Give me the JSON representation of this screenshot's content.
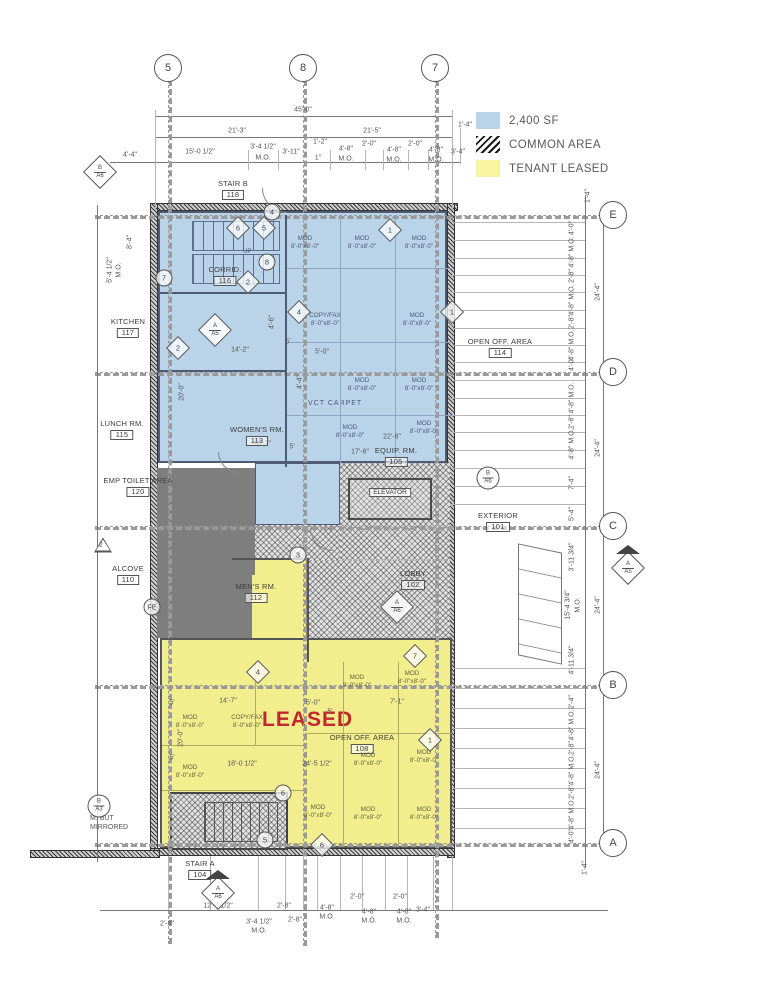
{
  "legend": {
    "items": [
      {
        "swatch": "sf",
        "label": "2,400 SF"
      },
      {
        "swatch": "common",
        "label": "COMMON AREA"
      },
      {
        "swatch": "leased",
        "label": "TENANT LEASED"
      }
    ]
  },
  "colors": {
    "tenant_blue": "#b9d3e8",
    "tenant_yellow": "#f3ee8d",
    "legend_yellow": "#f9f59f",
    "covered_gray": "#7e7e7e",
    "leased_red": "#c0282e",
    "line_gray": "#5a5a5a"
  },
  "grid": {
    "top": [
      {
        "label": "5",
        "x": 168
      },
      {
        "label": "8",
        "x": 303
      },
      {
        "label": "7",
        "x": 435
      }
    ],
    "right": [
      {
        "label": "E",
        "y": 215
      },
      {
        "label": "D",
        "y": 372
      },
      {
        "label": "C",
        "y": 526
      },
      {
        "label": "B",
        "y": 685
      },
      {
        "label": "A",
        "y": 843
      }
    ]
  },
  "rooms": [
    {
      "name": "STAIR B",
      "num": "118",
      "x": 233,
      "y": 180
    },
    {
      "name": "CORRID.",
      "num": "116",
      "x": 225,
      "y": 266
    },
    {
      "name": "KITCHEN",
      "num": "117",
      "x": 128,
      "y": 318
    },
    {
      "name": "LUNCH RM.",
      "num": "115",
      "x": 122,
      "y": 420
    },
    {
      "name": "WOMEN'S RM.",
      "num": "113",
      "x": 257,
      "y": 426
    },
    {
      "name": "EMP TOILET AREA",
      "num": "120",
      "x": 138,
      "y": 477
    },
    {
      "name": "ALCOVE",
      "num": "110",
      "x": 128,
      "y": 565
    },
    {
      "name": "MEN'S RM.",
      "num": "112",
      "x": 256,
      "y": 583
    },
    {
      "name": "OPEN OFF. AREA",
      "num": "114",
      "x": 500,
      "y": 338
    },
    {
      "name": "EQUIP. RM.",
      "num": "105",
      "x": 396,
      "y": 447
    },
    {
      "name": "ELEVATOR",
      "num": "",
      "x": 390,
      "y": 497
    },
    {
      "name": "LOBBY",
      "num": "102",
      "x": 413,
      "y": 570
    },
    {
      "name": "EXTERIOR",
      "num": "101",
      "x": 498,
      "y": 512
    },
    {
      "name": "OPEN OFF. AREA",
      "num": "108",
      "x": 362,
      "y": 734
    },
    {
      "name": "STAIR A",
      "num": "104",
      "x": 200,
      "y": 860
    }
  ],
  "mods": [
    {
      "a": "MOD",
      "s": "8'-0\"x8'-0\"",
      "x": 305,
      "y": 243,
      "c": "b"
    },
    {
      "a": "MOD",
      "s": "8'-0\"x8'-0\"",
      "x": 362,
      "y": 243,
      "c": "b"
    },
    {
      "a": "MOD",
      "s": "8'-0\"x8'-0\"",
      "x": 419,
      "y": 243,
      "c": "b"
    },
    {
      "a": "COPY/FAX",
      "s": "8'-0\"x8'-0\"",
      "x": 325,
      "y": 320,
      "c": "b"
    },
    {
      "a": "MOD",
      "s": "8'-0\"x8'-0\"",
      "x": 417,
      "y": 320,
      "c": "b"
    },
    {
      "a": "MOD",
      "s": "8'-0\"x8'-0\"",
      "x": 362,
      "y": 385,
      "c": "b"
    },
    {
      "a": "MOD",
      "s": "8'-0\"x8'-0\"",
      "x": 419,
      "y": 385,
      "c": "b"
    },
    {
      "a": "MOD",
      "s": "8'-0\"x8'-0\"",
      "x": 350,
      "y": 432,
      "c": "b"
    },
    {
      "a": "MOD",
      "s": "8'-0\"x8'-0\"",
      "x": 424,
      "y": 428,
      "c": "b"
    },
    {
      "a": "MOD",
      "s": "8'-0\"x8'-0\"",
      "x": 190,
      "y": 722,
      "c": "y"
    },
    {
      "a": "COPY/FAX",
      "s": "8'-0\"x8'-0\"",
      "x": 247,
      "y": 722,
      "c": "y"
    },
    {
      "a": "MOD",
      "s": "8'-0\"x8'-0\"",
      "x": 357,
      "y": 682,
      "c": "y"
    },
    {
      "a": "MOD",
      "s": "8'-0\"x8'-0\"",
      "x": 412,
      "y": 678,
      "c": "y"
    },
    {
      "a": "MOD",
      "s": "8'-0\"x8'-0\"",
      "x": 190,
      "y": 772,
      "c": "y"
    },
    {
      "a": "MOD",
      "s": "8'-0\"x8'-0\"",
      "x": 368,
      "y": 760,
      "c": "y"
    },
    {
      "a": "MOD",
      "s": "8'-0\"x8'-0\"",
      "x": 424,
      "y": 757,
      "c": "y"
    },
    {
      "a": "MOD",
      "s": "8'-0\"x8'-0\"",
      "x": 318,
      "y": 812,
      "c": "y"
    },
    {
      "a": "MOD",
      "s": "8'-0\"x8'-0\"",
      "x": 368,
      "y": 814,
      "c": "y"
    },
    {
      "a": "MOD",
      "s": "8'-0\"x8'-0\"",
      "x": 424,
      "y": 814,
      "c": "y"
    }
  ],
  "dimensions": [
    {
      "t": "45'-0\"",
      "x": 303,
      "y": 110
    },
    {
      "t": "21'-3\"",
      "x": 237,
      "y": 131
    },
    {
      "t": "21'-5\"",
      "x": 372,
      "y": 131
    },
    {
      "t": "1'-4\"",
      "x": 465,
      "y": 125
    },
    {
      "t": "4'-4\"",
      "x": 130,
      "y": 155
    },
    {
      "t": "15'-0 1/2\"",
      "x": 200,
      "y": 152
    },
    {
      "t": "3'-4 1/2\"",
      "x": 263,
      "y": 147
    },
    {
      "t": "M.O.",
      "x": 263,
      "y": 158
    },
    {
      "t": "3'-11\"",
      "x": 291,
      "y": 152
    },
    {
      "t": "1'-2\"",
      "x": 320,
      "y": 142
    },
    {
      "t": "1\"",
      "x": 318,
      "y": 158
    },
    {
      "t": "4'-8\"",
      "x": 346,
      "y": 149
    },
    {
      "t": "M.O.",
      "x": 346,
      "y": 159
    },
    {
      "t": "2'-0\"",
      "x": 369,
      "y": 144
    },
    {
      "t": "4'-8\"",
      "x": 394,
      "y": 150
    },
    {
      "t": "M.O.",
      "x": 394,
      "y": 160
    },
    {
      "t": "2'-0\"",
      "x": 415,
      "y": 144
    },
    {
      "t": "4'-8\"",
      "x": 436,
      "y": 150
    },
    {
      "t": "M.O.",
      "x": 436,
      "y": 160
    },
    {
      "t": "3'-4\"",
      "x": 458,
      "y": 152
    },
    {
      "t": "8'-4\"",
      "x": 130,
      "y": 242,
      "r": 1
    },
    {
      "t": "5'-4 1/2\"",
      "x": 110,
      "y": 270,
      "r": 1
    },
    {
      "t": "M.O.",
      "x": 119,
      "y": 270,
      "r": 1
    },
    {
      "t": "20'-0\"",
      "x": 182,
      "y": 392,
      "r": 1
    },
    {
      "t": "14'-2\"",
      "x": 240,
      "y": 350
    },
    {
      "t": "5'",
      "x": 288,
      "y": 342
    },
    {
      "t": "5'-0\"",
      "x": 322,
      "y": 352
    },
    {
      "t": "4'-6\"",
      "x": 272,
      "y": 322,
      "r": 1
    },
    {
      "t": "4'-4\"",
      "x": 300,
      "y": 382,
      "r": 1
    },
    {
      "t": "10'-7\"",
      "x": 262,
      "y": 444
    },
    {
      "t": "5'",
      "x": 292,
      "y": 447
    },
    {
      "t": "22'-6\"",
      "x": 392,
      "y": 437
    },
    {
      "t": "17'-6\"",
      "x": 360,
      "y": 452
    },
    {
      "t": "1'-4\"",
      "x": 588,
      "y": 196,
      "r": 1
    },
    {
      "t": "4'-0\"",
      "x": 572,
      "y": 228,
      "r": 1
    },
    {
      "t": "4'-8\" M.O.",
      "x": 572,
      "y": 252,
      "r": 1
    },
    {
      "t": "2'-8\"",
      "x": 572,
      "y": 276,
      "r": 1
    },
    {
      "t": "4'-8\" M.O.",
      "x": 572,
      "y": 300,
      "r": 1
    },
    {
      "t": "2'-8\"",
      "x": 572,
      "y": 322,
      "r": 1
    },
    {
      "t": "4'-8\" M.O.",
      "x": 572,
      "y": 345,
      "r": 1
    },
    {
      "t": "4'-0\"",
      "x": 572,
      "y": 364,
      "r": 1
    },
    {
      "t": "24'-4\"",
      "x": 598,
      "y": 292,
      "r": 1
    },
    {
      "t": "4'-8\" M.O.",
      "x": 572,
      "y": 398,
      "r": 1
    },
    {
      "t": "2'-8\"",
      "x": 572,
      "y": 422,
      "r": 1
    },
    {
      "t": "4'-8\" M.O.",
      "x": 572,
      "y": 444,
      "r": 1
    },
    {
      "t": "7'-4\"",
      "x": 572,
      "y": 483,
      "r": 1
    },
    {
      "t": "5'-4\"",
      "x": 572,
      "y": 514,
      "r": 1
    },
    {
      "t": "24'-4\"",
      "x": 598,
      "y": 448,
      "r": 1
    },
    {
      "t": "3'-11 3/4\"",
      "x": 572,
      "y": 557,
      "r": 1
    },
    {
      "t": "15'-4 3/4\"",
      "x": 568,
      "y": 605,
      "r": 1
    },
    {
      "t": "M.O.",
      "x": 578,
      "y": 605,
      "r": 1
    },
    {
      "t": "4'-11 3/4\"",
      "x": 572,
      "y": 660,
      "r": 1
    },
    {
      "t": "24'-4\"",
      "x": 598,
      "y": 605,
      "r": 1
    },
    {
      "t": "2'-4\"",
      "x": 572,
      "y": 702,
      "r": 1
    },
    {
      "t": "4'-8\" M.O.",
      "x": 572,
      "y": 725,
      "r": 1
    },
    {
      "t": "2'-8\"",
      "x": 572,
      "y": 748,
      "r": 1
    },
    {
      "t": "4'-8\" M.O.",
      "x": 572,
      "y": 770,
      "r": 1
    },
    {
      "t": "2'-8\"",
      "x": 572,
      "y": 792,
      "r": 1
    },
    {
      "t": "4'-8\" M.O.",
      "x": 572,
      "y": 814,
      "r": 1
    },
    {
      "t": "4'-0\"",
      "x": 572,
      "y": 836,
      "r": 1
    },
    {
      "t": "24'-4\"",
      "x": 598,
      "y": 770,
      "r": 1
    },
    {
      "t": "1'-4\"",
      "x": 585,
      "y": 868,
      "r": 1
    },
    {
      "t": "5'",
      "x": 172,
      "y": 703
    },
    {
      "t": "14'-7\"",
      "x": 228,
      "y": 701
    },
    {
      "t": "5'-0\"",
      "x": 313,
      "y": 703
    },
    {
      "t": "5'",
      "x": 330,
      "y": 712
    },
    {
      "t": "7'-1\"",
      "x": 397,
      "y": 702
    },
    {
      "t": "20'-0\"",
      "x": 181,
      "y": 738,
      "r": 1
    },
    {
      "t": "5'",
      "x": 172,
      "y": 758
    },
    {
      "t": "18'-0 1/2\"",
      "x": 242,
      "y": 764
    },
    {
      "t": "24'-5 1/2\"",
      "x": 317,
      "y": 764
    },
    {
      "t": "12'-5 1/2\"",
      "x": 218,
      "y": 906
    },
    {
      "t": "2'-8\"",
      "x": 167,
      "y": 924
    },
    {
      "t": "2'-8\"",
      "x": 284,
      "y": 906
    },
    {
      "t": "3'-4 1/2\"",
      "x": 259,
      "y": 922
    },
    {
      "t": "M.O.",
      "x": 259,
      "y": 931
    },
    {
      "t": "2'-8\"",
      "x": 295,
      "y": 920
    },
    {
      "t": "4'-8\"",
      "x": 327,
      "y": 908
    },
    {
      "t": "M.O.",
      "x": 327,
      "y": 917
    },
    {
      "t": "2'-0\"",
      "x": 357,
      "y": 897
    },
    {
      "t": "4'-8\"",
      "x": 369,
      "y": 912
    },
    {
      "t": "M.O.",
      "x": 369,
      "y": 921
    },
    {
      "t": "2'-0\"",
      "x": 400,
      "y": 897
    },
    {
      "t": "4'-8\"",
      "x": 404,
      "y": 912
    },
    {
      "t": "M.O.",
      "x": 404,
      "y": 921
    },
    {
      "t": "3'-4\"",
      "x": 423,
      "y": 910
    }
  ],
  "ref_tags": [
    {
      "t": "d2",
      "a": "B",
      "b": "A6",
      "x": 100,
      "y": 172
    },
    {
      "t": "c2",
      "a": "B",
      "b": "A6",
      "x": 488,
      "y": 478
    },
    {
      "t": "c2",
      "a": "B",
      "b": "A3",
      "x": 99,
      "y": 806
    },
    {
      "t": "d2t",
      "a": "A",
      "b": "A6",
      "x": 218,
      "y": 893
    },
    {
      "t": "d2t",
      "a": "A",
      "b": "A5",
      "x": 628,
      "y": 568
    },
    {
      "t": "d2",
      "a": "A",
      "b": "A6",
      "x": 397,
      "y": 607
    },
    {
      "t": "d2",
      "a": "A",
      "b": "A5",
      "x": 215,
      "y": 330
    },
    {
      "t": "tri",
      "a": "2",
      "x": 103,
      "y": 545
    },
    {
      "t": "c",
      "a": "FE",
      "x": 152,
      "y": 607
    },
    {
      "t": "c",
      "a": "4",
      "x": 272,
      "y": 212
    },
    {
      "t": "c",
      "a": "8",
      "x": 267,
      "y": 262
    },
    {
      "t": "c",
      "a": "7",
      "x": 164,
      "y": 278
    },
    {
      "t": "c",
      "a": "3",
      "x": 298,
      "y": 555
    },
    {
      "t": "c",
      "a": "6",
      "x": 283,
      "y": 793
    },
    {
      "t": "c",
      "a": "5",
      "x": 265,
      "y": 840
    },
    {
      "t": "d",
      "a": "6",
      "x": 238,
      "y": 228
    },
    {
      "t": "d",
      "a": "5",
      "x": 264,
      "y": 228
    },
    {
      "t": "d",
      "a": "1",
      "x": 390,
      "y": 230
    },
    {
      "t": "d",
      "a": "2",
      "x": 248,
      "y": 282
    },
    {
      "t": "d",
      "a": "4",
      "x": 299,
      "y": 312
    },
    {
      "t": "d",
      "a": "2",
      "x": 178,
      "y": 348
    },
    {
      "t": "d",
      "a": "1",
      "x": 452,
      "y": 312
    },
    {
      "t": "d",
      "a": "4",
      "x": 258,
      "y": 672
    },
    {
      "t": "d",
      "a": "7",
      "x": 415,
      "y": 656
    },
    {
      "t": "d",
      "a": "1",
      "x": 430,
      "y": 740
    },
    {
      "t": "d",
      "a": "6",
      "x": 322,
      "y": 845
    }
  ],
  "annotations": {
    "leased": "LEASED",
    "vct_carpet": "VCT CARPET",
    "up": "UP",
    "mirrored_line1": "M. BUT",
    "mirrored_line2": "MIRRORED"
  }
}
